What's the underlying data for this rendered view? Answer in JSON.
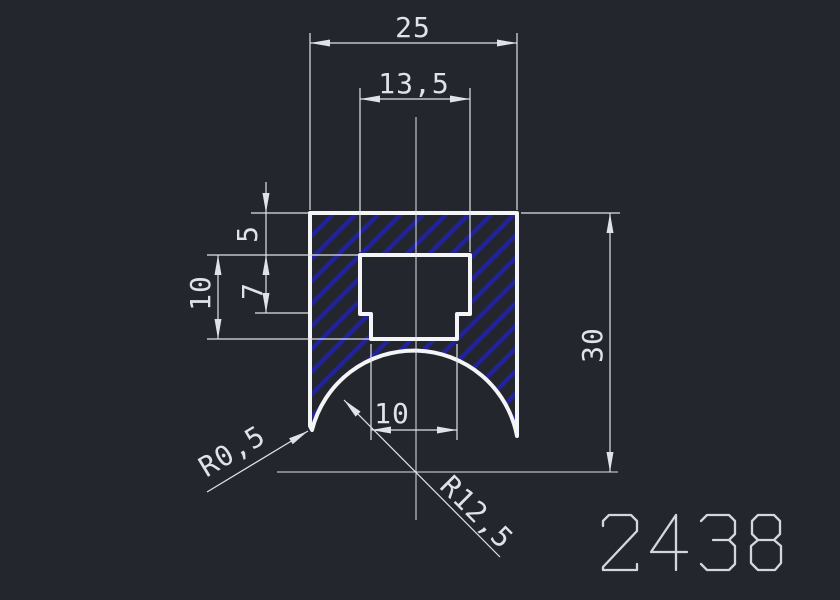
{
  "colors": {
    "background": "#23272D",
    "dim": "#DFE3E7",
    "outline": "#F4F5F7",
    "hatch": "#22229E",
    "part": "#D2D7DE"
  },
  "dimensions": {
    "overall_width": "25",
    "slot_width": "13,5",
    "top_thickness": "5",
    "slot_step_depth": "7",
    "slot_depth": "10",
    "overall_height": "30",
    "slot_bottom_width": "10",
    "tip_radius": "R0,5",
    "arc_radius": "R12,5"
  },
  "part_number": "2438"
}
